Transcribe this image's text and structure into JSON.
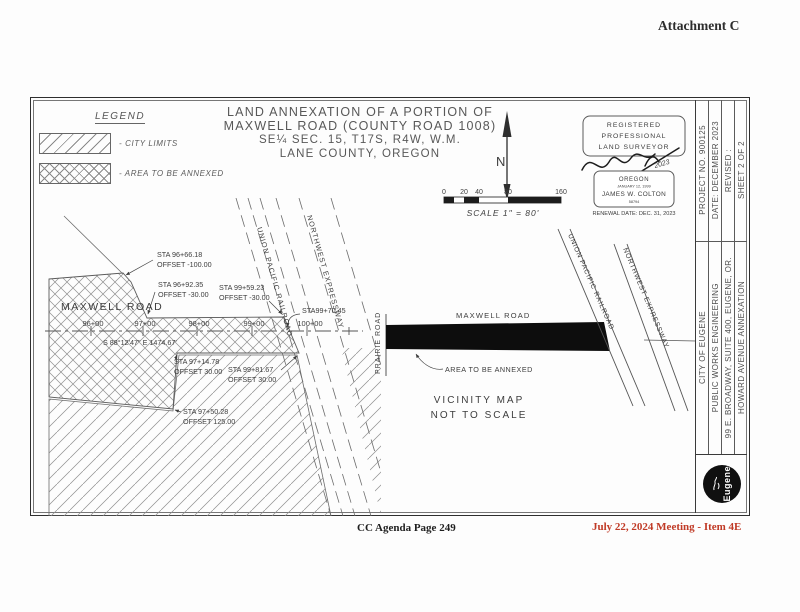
{
  "page": {
    "attachment_label": "Attachment C",
    "footer_left": "CC Agenda Page 249",
    "footer_right": "July 22, 2024 Meeting - Item 4E"
  },
  "colors": {
    "footer_red": "#c03a26",
    "ink_gray": "#3f3f3f",
    "annexed_bar_fill": "#0d0d0d"
  },
  "legend": {
    "title": "LEGEND",
    "items": [
      {
        "label": "- CITY LIMITS",
        "pattern": "diagonal-hatch"
      },
      {
        "label": "- AREA TO BE ANNEXED",
        "pattern": "cross-hatch"
      }
    ]
  },
  "map_title": {
    "line1": "LAND ANNEXATION OF A PORTION OF",
    "line2": "MAXWELL ROAD (COUNTY ROAD 1008)",
    "line3": "SE¼ SEC. 15, T17S, R4W, W.M.",
    "line4": "LANE COUNTY, OREGON"
  },
  "north_label": "N",
  "scale_bar": {
    "ticks": [
      "0",
      "20",
      "40",
      "80",
      "160"
    ],
    "label": "SCALE 1\" = 80'"
  },
  "stamp": {
    "line1": "REGISTERED",
    "line2": "PROFESSIONAL",
    "line3": "LAND SURVEYOR",
    "signature_year": "2023",
    "state": "OREGON",
    "license_date": "JANUARY 12, 1999",
    "name": "JAMES W. COLTON",
    "number": "58794",
    "renewal": "RENEWAL DATE: DEC. 31, 2023"
  },
  "title_block": {
    "rows_top": [
      "PROJECT NO. 900125",
      "DATE: DECEMBER 2023",
      "REVISED :",
      "SHEET 2 OF 2"
    ],
    "rows_bottom": [
      "CITY OF EUGENE",
      "PUBLIC WORKS ENGINEERING",
      "99 E. BROADWAY, SUITE 400, EUGENE, OR.",
      "HOWARD AVENUE ANNEXATION"
    ],
    "logo_text": "Eugene"
  },
  "plan": {
    "road": "MAXWELL ROAD",
    "bearing": "S 88°12'47\" E 1474.67'",
    "stations": [
      "96+00",
      "97+00",
      "98+00",
      "99+00",
      "100+00"
    ],
    "railroad": "UNION PACIFIC RAILROAD",
    "expressway": "NORTHWEST EXPRESSWAY",
    "callouts": [
      {
        "sta": "STA 96+66.18",
        "offset": "OFFSET -100.00"
      },
      {
        "sta": "STA 96+92.35",
        "offset": "OFFSET -30.00"
      },
      {
        "sta": "STA 99+59.23",
        "offset": "OFFSET -30.00"
      },
      {
        "sta": "STA99+70.45",
        "offset": ""
      },
      {
        "sta": "STA 97+14.78",
        "offset": "OFFSET 30.00"
      },
      {
        "sta": "STA 99+81.67",
        "offset": "OFFSET 30.00"
      },
      {
        "sta": "STA 97+50.28",
        "offset": "OFFSET 125.00"
      }
    ]
  },
  "vicinity": {
    "prairie_road": "PRAIRIE ROAD",
    "maxwell_road": "MAXWELL ROAD",
    "railroad": "UNION PACIFIC RAILROAD",
    "expressway": "NORTHWEST EXPRESSWAY",
    "annex_label": "AREA TO BE ANNEXED",
    "caption1": "VICINITY MAP",
    "caption2": "NOT TO SCALE"
  }
}
